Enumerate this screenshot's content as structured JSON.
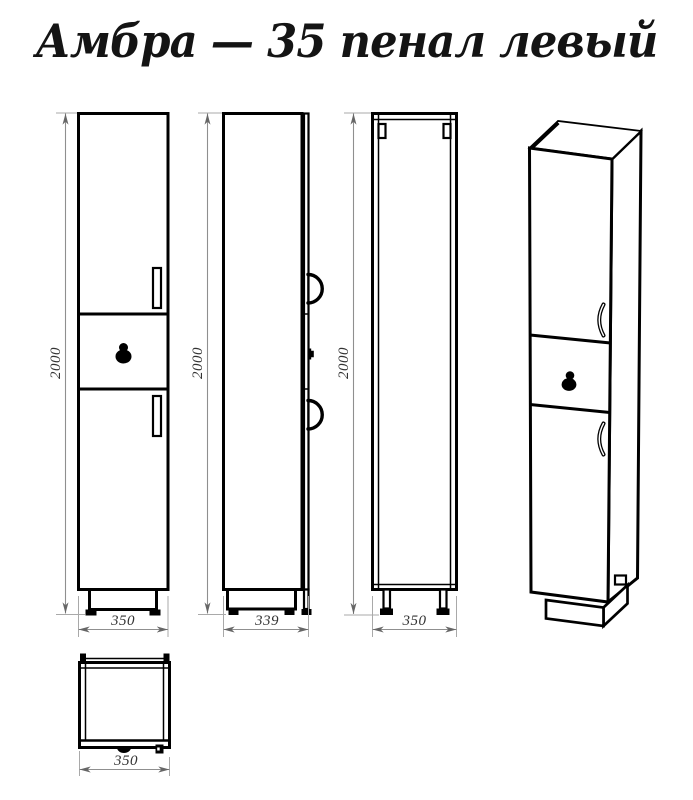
{
  "title": "Амбра — 35 пенал левый",
  "dimensions": {
    "front_height": "2000",
    "front_width": "350",
    "side_height": "2000",
    "side_depth": "339",
    "back_height": "2000",
    "back_width": "350",
    "top_width": "350"
  },
  "colors": {
    "line": "#000000",
    "dimension_line": "#8f8f8f",
    "dimension_text": "#333333",
    "background": "#ffffff"
  }
}
